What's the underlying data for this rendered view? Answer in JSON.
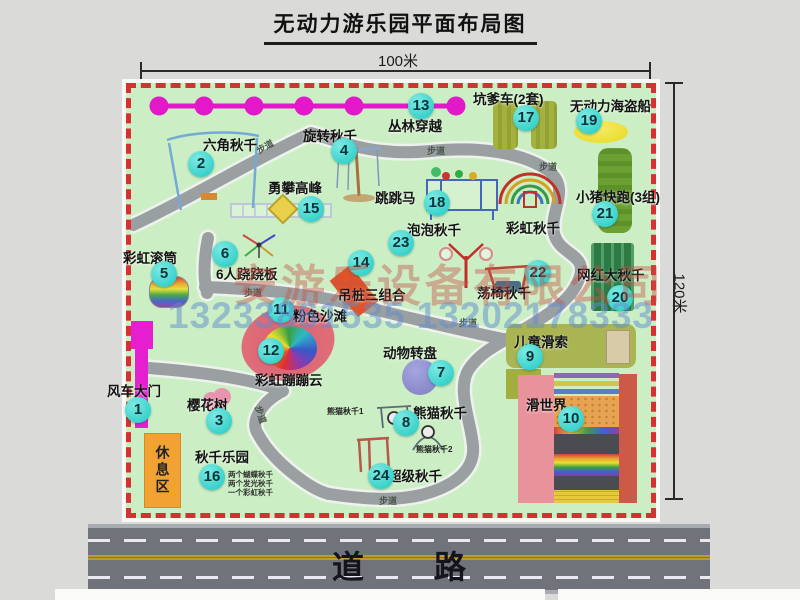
{
  "title": "无动力游乐园平面布局图",
  "dimensions": {
    "top": "100米",
    "right": "120米"
  },
  "road_label": "道路",
  "watermark": {
    "company": "安游乐设备有限公司",
    "phone": "13233861535 13202178333"
  },
  "map": {
    "path_label": "步道",
    "rest_area_label": "休息区",
    "rainbow_swing_label": "彩虹秋千",
    "attractions": [
      {
        "num": "1",
        "label": "风车大门"
      },
      {
        "num": "2",
        "label": "六角秋千"
      },
      {
        "num": "3",
        "label": "樱花树"
      },
      {
        "num": "4",
        "label": "旋转秋千"
      },
      {
        "num": "5",
        "label": "彩虹滚筒"
      },
      {
        "num": "6",
        "label": "6人跷跷板"
      },
      {
        "num": "7",
        "label": "动物转盘"
      },
      {
        "num": "8",
        "label": "熊猫秋千"
      },
      {
        "num": "9",
        "label": "儿童滑索"
      },
      {
        "num": "10",
        "label": "滑世界"
      },
      {
        "num": "11",
        "label": "粉色沙滩"
      },
      {
        "num": "12",
        "label": "彩虹蹦蹦云"
      },
      {
        "num": "13",
        "label": "丛林穿越"
      },
      {
        "num": "14",
        "label": "吊桩三组合"
      },
      {
        "num": "15",
        "label": "勇攀高峰"
      },
      {
        "num": "16",
        "label": "秋千乐园"
      },
      {
        "num": "17",
        "label": "坑爹车(2套)"
      },
      {
        "num": "18",
        "label": "跳跳马"
      },
      {
        "num": "19",
        "label": "无动力海盗船"
      },
      {
        "num": "20",
        "label": "网红大秋千"
      },
      {
        "num": "21",
        "label": "小猪快跑(3组)"
      },
      {
        "num": "22",
        "label": "荡椅秋千"
      },
      {
        "num": "23",
        "label": "泡泡秋千"
      },
      {
        "num": "24",
        "label": "超级秋千"
      }
    ],
    "extra": {
      "panda_swing_1": "熊猫秋千1",
      "panda_swing_2": "熊猫秋千2",
      "swing_park_notes": [
        "两个蝴蝶秋千",
        "两个发光秋千",
        "一个彩虹秋千"
      ]
    },
    "colors": {
      "map_green": "#cbeec4",
      "border_red": "#d63030",
      "badge_cyan": "#2fd7cf",
      "chain_magenta": "#e318c9",
      "gate_magenta": "#e51fd0",
      "rest_orange": "#f2a233",
      "road_gray": "#70737a",
      "path_gray": "#9aa0a2"
    }
  }
}
